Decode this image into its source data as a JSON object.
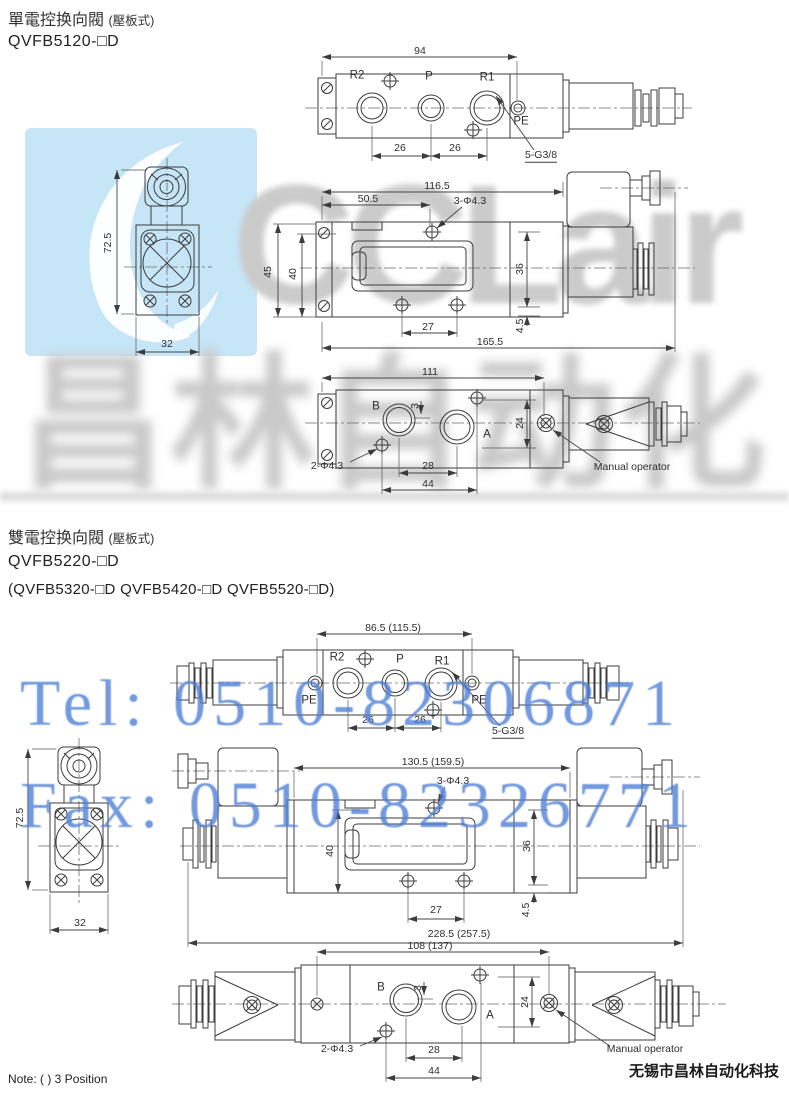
{
  "watermark": {
    "brand": "CCLair",
    "brand_cn": "昌林自动化",
    "tel": "Tel: 0510-82306871",
    "fax": "Fax: 0510-82326771",
    "logo_color": "#c6e6f8",
    "gray": "#cbcbcb",
    "blue": "#4d7ed6"
  },
  "footer": {
    "note": "Note: ( ) 3 Position",
    "company": "无锡市昌林自动化科技"
  },
  "section1": {
    "title": "單電控换向閥",
    "title_suffix": "(壓板式)",
    "model": "QVFB5120-□D",
    "top_view": {
      "dim_94": "94",
      "r2": "R2",
      "p": "P",
      "r1": "R1",
      "pe": "PE",
      "dim_26_left": "26",
      "dim_26_right": "26",
      "thread": "5-G3/8"
    },
    "side_view": {
      "dim_72_5": "72.5",
      "dim_32": "32"
    },
    "front_view": {
      "dim_116_5": "116.5",
      "dim_50_5": "50.5",
      "holes": "3-Φ4.3",
      "dim_45": "45",
      "dim_40": "40",
      "dim_36": "36",
      "dim_27": "27",
      "dim_4_5": "4.5",
      "dim_165_5": "165.5"
    },
    "bottom_view": {
      "dim_111": "111",
      "b": "B",
      "a": "A",
      "dim_3": "3",
      "dim_24": "24",
      "dim_28": "28",
      "dim_44": "44",
      "holes": "2-Φ4.3",
      "manual": "Manual operator"
    }
  },
  "section2": {
    "title": "雙電控换向閥",
    "title_suffix": "(壓板式)",
    "model": "QVFB5220-□D",
    "variants": "(QVFB5320-□D  QVFB5420-□D  QVFB5520-□D)",
    "top_view": {
      "dim_86_5": "86.5 (115.5)",
      "r2": "R2",
      "p": "P",
      "r1": "R1",
      "pe_left": "PE",
      "pe_right": "PE",
      "dim_26_left": "26",
      "dim_26_right": "26",
      "thread": "5-G3/8"
    },
    "side_view": {
      "dim_72_5": "72.5",
      "dim_32": "32"
    },
    "front_view": {
      "dim_130_5": "130.5 (159.5)",
      "holes": "3-Φ4.3",
      "dim_40": "40",
      "dim_36": "36",
      "dim_27": "27",
      "dim_4_5": "4.5",
      "dim_228_5": "228.5 (257.5)"
    },
    "bottom_view": {
      "dim_108": "108 (137)",
      "b": "B",
      "a": "A",
      "dim_3": "3",
      "dim_24": "24",
      "dim_28": "28",
      "dim_44": "44",
      "holes": "2-Φ4.3",
      "manual": "Manual operator"
    }
  }
}
